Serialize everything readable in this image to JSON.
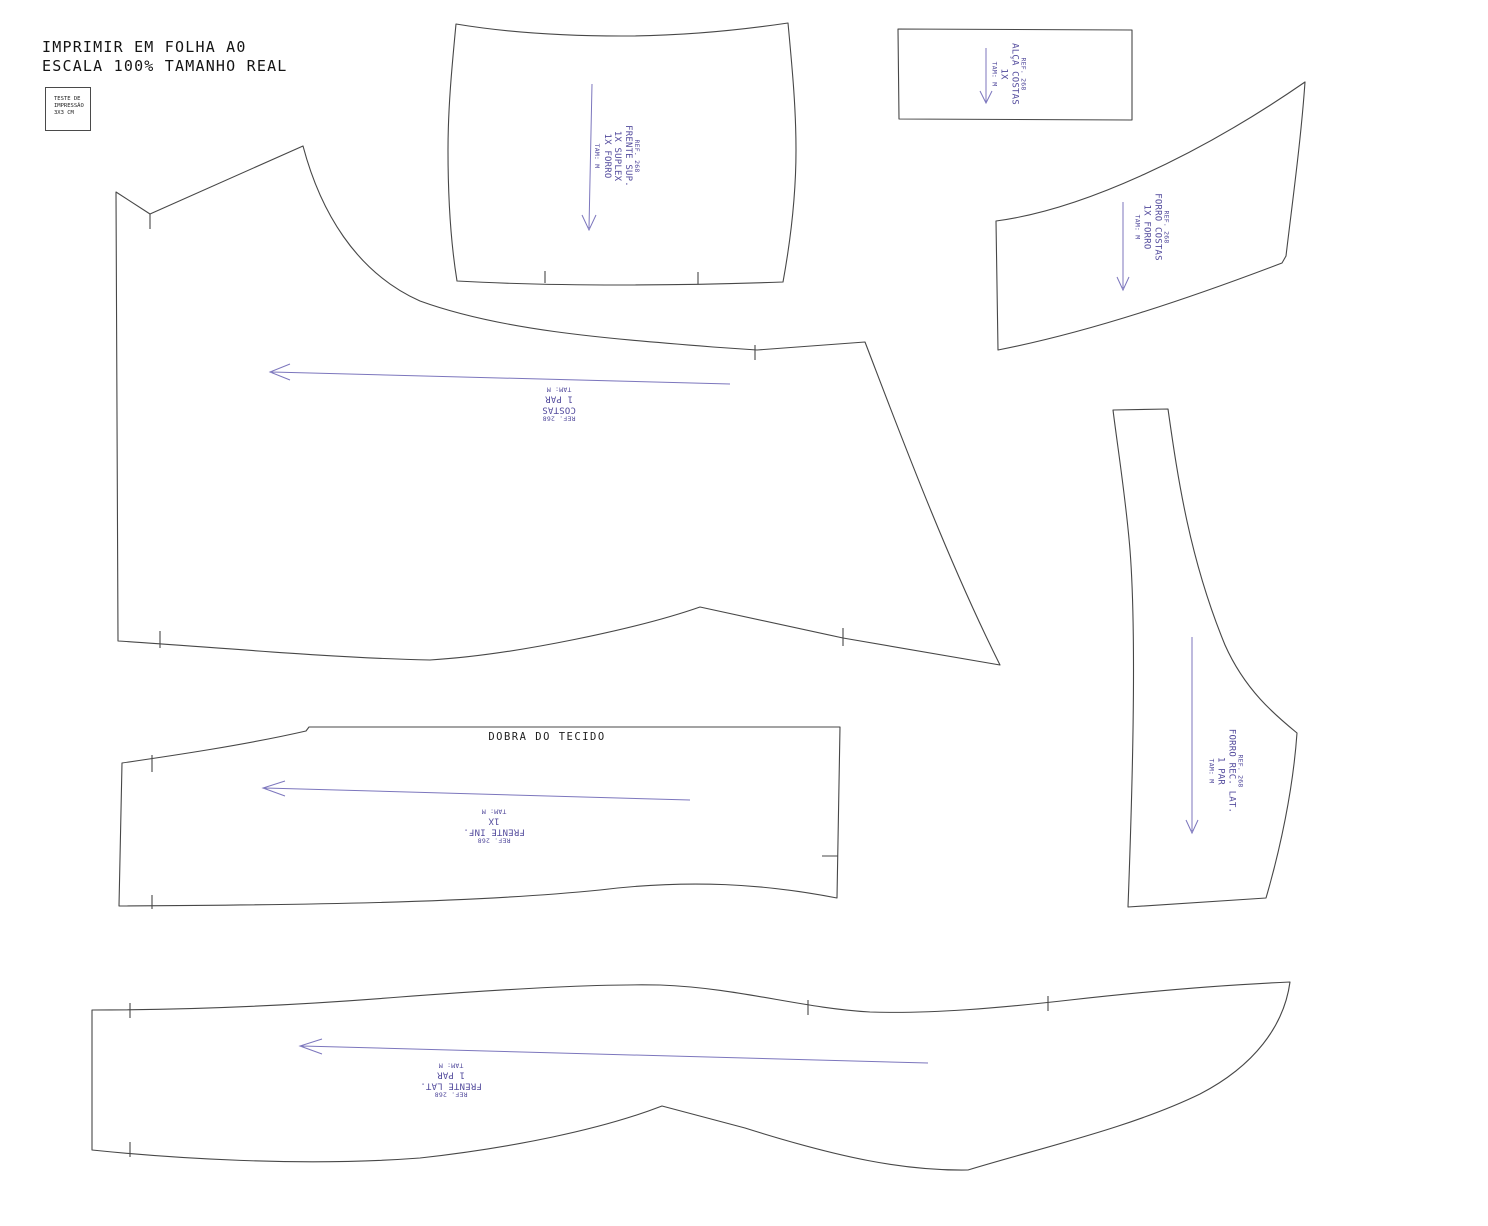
{
  "header": {
    "line1": "IMPRIMIR EM FOLHA A0",
    "line2": "ESCALA 100% TAMANHO REAL"
  },
  "test_square": {
    "line1": "TESTE DE",
    "line2": "IMPRESSÃO",
    "line3": "3X3 CM"
  },
  "fold_label": "DOBRA DO TECIDO",
  "colors": {
    "outline": "#474747",
    "label_purple": "#524a9c",
    "arrow_purple": "#7c76bd",
    "text_black": "#141414",
    "background": "#ffffff"
  },
  "pieces": [
    {
      "id": "frente-sup",
      "ref": "REF. 268",
      "name": "FRENTE SUP.",
      "qty1": "1X SUPLEX",
      "qty2": "1X FORRO",
      "size": "TAM: M",
      "rotation": 90
    },
    {
      "id": "alca-costas",
      "ref": "REF. 268",
      "name": "ALÇA COSTAS",
      "qty1": "1X",
      "size": "TAM: M",
      "rotation": 90
    },
    {
      "id": "forro-costas",
      "ref": "REF. 268",
      "name": "FORRO COSTAS",
      "qty1": "1X FORRO",
      "size": "TAM: M",
      "rotation": 90
    },
    {
      "id": "costas",
      "ref": "REF. 268",
      "name": "COSTAS",
      "qty1": "1 PAR",
      "size": "TAM: M",
      "rotation": 180
    },
    {
      "id": "frente-inf",
      "ref": "REF. 268",
      "name": "FRENTE INF.",
      "qty1": "1X",
      "size": "TAM: M",
      "rotation": 180
    },
    {
      "id": "forro-rec-lat",
      "ref": "REF. 268",
      "name": "FORRO REC. LAT.",
      "qty1": "1 PAR",
      "size": "TAM: M",
      "rotation": 90
    },
    {
      "id": "frente-lat",
      "ref": "REF. 268",
      "name": "FRENTE LAT.",
      "qty1": "1 PAR",
      "size": "TAM: M",
      "rotation": 180
    }
  ]
}
